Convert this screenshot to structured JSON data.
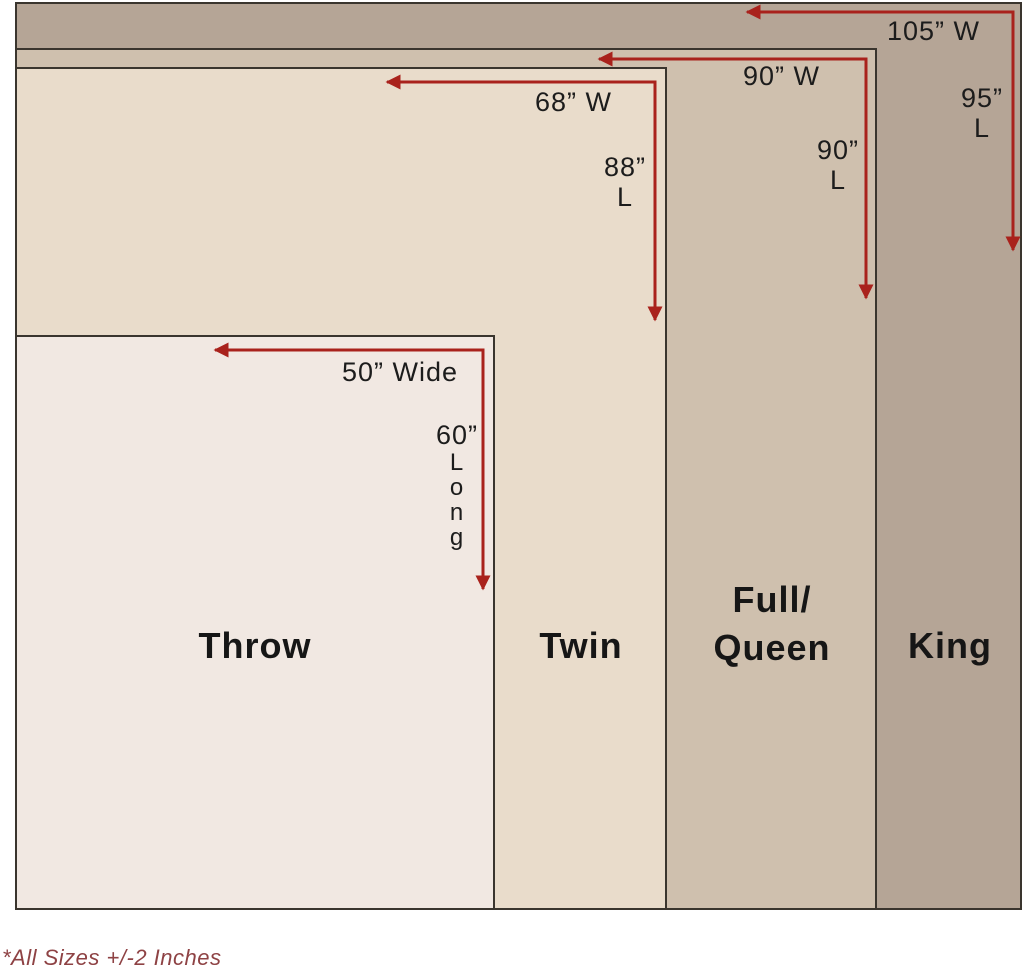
{
  "diagram": {
    "note": "*All Sizes +/-2 Inches",
    "arrow_color": "#a9221c",
    "note_color": "#8e4244",
    "text_color": "#1c1c1c",
    "border_color": "#3a352e",
    "sizes": [
      {
        "id": "king",
        "name": "King",
        "width_label": "105” W",
        "length_value": "95”",
        "length_word": "L",
        "color": "#b5a596"
      },
      {
        "id": "full-queen",
        "name_line1": "Full/",
        "name_line2": "Queen",
        "width_label": "90” W",
        "length_value": "90”",
        "length_word": "L",
        "color": "#cfc0ae"
      },
      {
        "id": "twin",
        "name": "Twin",
        "width_label": "68” W",
        "length_value": "88”",
        "length_word": "L",
        "color": "#e9dccb"
      },
      {
        "id": "throw",
        "name": "Throw",
        "width_label": "50” Wide",
        "length_value": "60”",
        "length_letters": [
          "L",
          "o",
          "n",
          "g"
        ],
        "color": "#f1e8e2"
      }
    ]
  }
}
